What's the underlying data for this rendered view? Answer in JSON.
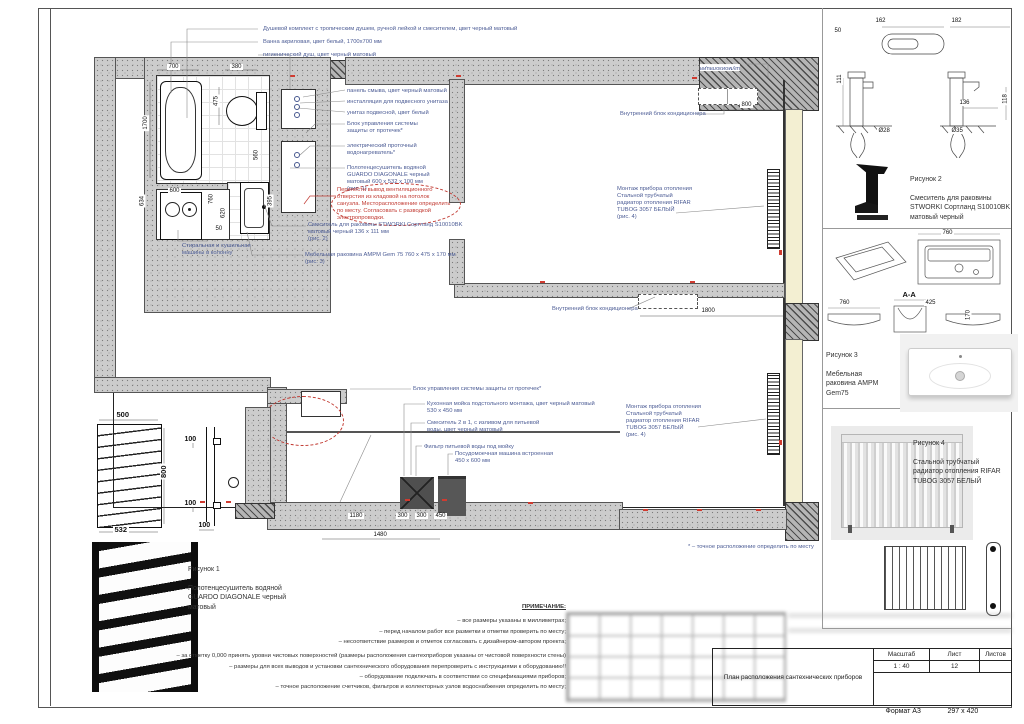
{
  "sheet": {
    "format": "Формат А3",
    "size": "297 х 420"
  },
  "titleblock": {
    "title": "План расположения сантехнических приборов",
    "scale_label": "Масштаб",
    "scale": "1 : 40",
    "sheet_label": "Лист",
    "sheet": "12",
    "sheets_label": "Листов",
    "sheets": ""
  },
  "notes": {
    "heading": "ПРИМЕЧАНИЕ:",
    "items": [
      "– все размеры указаны в миллиметрах;",
      "– перед началом работ все разметки и отметки проверить по месту;",
      "– несоответствие размеров и отметок согласовать с дизайнером-автором проекта;",
      "– за отметку 0,000 принять уровни чистовых поверхностей (размеры расположения сантехприборов указаны от чистовой поверхности стены)",
      "– размеры для всех выводов и установки сантехнического оборудования перепроверить с инструкциями к оборудованию!!",
      "– оборудование подключать в соответствии со спецификациями приборов;",
      "– точное расположение счетчиков, фильтров и коллекторных узлов водоснабжения определить по месту;"
    ]
  },
  "callouts": {
    "shower": "Душевой комплект с тропическим душем, ручной лейкой и смесителем, цвет черный матовый",
    "bath": "Ванна акриловая, цвет белый, 1700х700 мм",
    "hygienic": "гигиенический душ, цвет черный матовый",
    "flush_panel": "панель смыва, цвет черный матовый",
    "installation": "инсталляция для подвесного унитаза",
    "wc": "унитаз подвесной, цвет белый",
    "leak_block": "Блок управления системы\nзащиты от протечек*",
    "water_heater": "электрический проточный\nводонагреватель*",
    "towel_dryer": "Полотенцесушитель водяной\nGUARDO DIAGONALE черный\nматовый 600 х 532 х 100 мм\n(рис. 1)",
    "vent_note": "Перенести вывод вентиляционного\nотверстия из кладовой на потолок\nсанузла. Месторасположение определить\nпо месту. Согласовать с разводкой\nэлектропроводки.",
    "basin_mixer": "Смеситель для раковины STWORKI Сортланд S10010BK\nматовый черный 136 х 111 мм\n(рис. 2)",
    "basin": "Мебельная раковина AMPM Gem 75 760 х 475 х 170 мм\n(рис. 3)",
    "washer_column": "Стиральная и сушильная\nмашины в колонну",
    "leak_block_2": "Блок управления системы защиты от протечек*",
    "kitchen_sink": "Кухонная мойка подстольного монтажа, цвет черный матовый\n530 х 450 мм",
    "kitchen_mixer": "Смеситель 2 в 1, с изливом для питьевой\nводы, цвет черный матовый",
    "water_filter": "Фильтр питьевой воды под мойку",
    "dishwasher": "Посудомоечная машина встроенная\n450 х 600 мм",
    "ac_unit": "Внутренний блок кондиционера",
    "radiator_note": "Монтаж прибора отопления\nСтальной трубчатый\nрадиатор отопления RIFAR\nTUBOG 3057 БЕЛЫЙ\n(рис. 4)",
    "soundproofing": "шумоизоляция",
    "footnote": "* –  точное расположение определить по месту"
  },
  "figures": {
    "fig1": {
      "title": "Рисунок 1",
      "caption": "Полотенцесушитель водяной\nGUARDO DIAGONALE черный\nматовый"
    },
    "fig2": {
      "title": "Рисунок 2",
      "caption": "Смеситель для раковины\nSTWORKI Сортланд S10010BK\nматовый черный"
    },
    "fig3": {
      "title": "Рисунок 3",
      "caption": "Мебельная\nраковина AMPM\nGem75"
    },
    "fig4": {
      "title": "Рисунок 4",
      "caption": "Стальной трубчатый\nрадиатор отопления RIFAR\nTUBOG 3057 БЕЛЫЙ"
    }
  },
  "dims": {
    "plan": {
      "bath_w": "700",
      "wc_w": "380",
      "wc_d": "475",
      "bath_l": "1700",
      "storage": "634",
      "washer": "600",
      "d760": "760",
      "d620": "620",
      "d560": "560",
      "d395": "395",
      "d50": "50",
      "ac_top": "800",
      "ac_mid": "1800",
      "k1180": "1180",
      "k300a": "300",
      "k300b": "300",
      "k450": "450",
      "k1480": "1480"
    },
    "fig1": {
      "w": "500",
      "h": "800",
      "w2": "532",
      "o1": "100",
      "o2": "100",
      "o3": "100"
    },
    "fig2": {
      "d162": "162",
      "d182": "182",
      "d50": "50",
      "d111": "111",
      "d136": "136",
      "d118": "118",
      "d28": "Ø28",
      "d35": "Ø35"
    },
    "fig3": {
      "top": "760",
      "w": "760",
      "section": "A-A",
      "d425": "425",
      "d170": "170"
    }
  },
  "colors": {
    "annotation_blue": "#4c5c95",
    "markup_red": "#c23b33",
    "window_fill": "#f3efd2"
  }
}
